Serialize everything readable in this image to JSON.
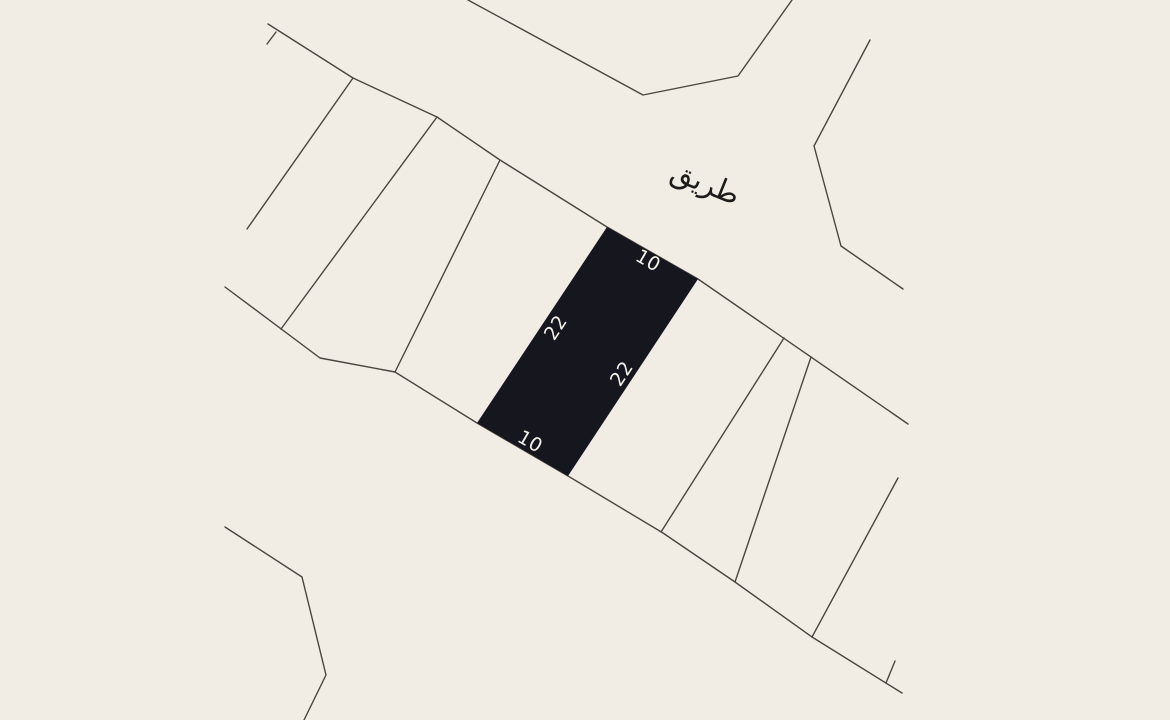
{
  "map": {
    "background_color": "#f1ece4",
    "line_color": "#4a453e",
    "road_label": "طريق",
    "highlighted_parcel": {
      "fill_color": "#16161e",
      "label_color": "#f4f1ea",
      "dimensions": {
        "top": "10",
        "right": "22",
        "bottom": "10",
        "left": "22"
      }
    }
  }
}
